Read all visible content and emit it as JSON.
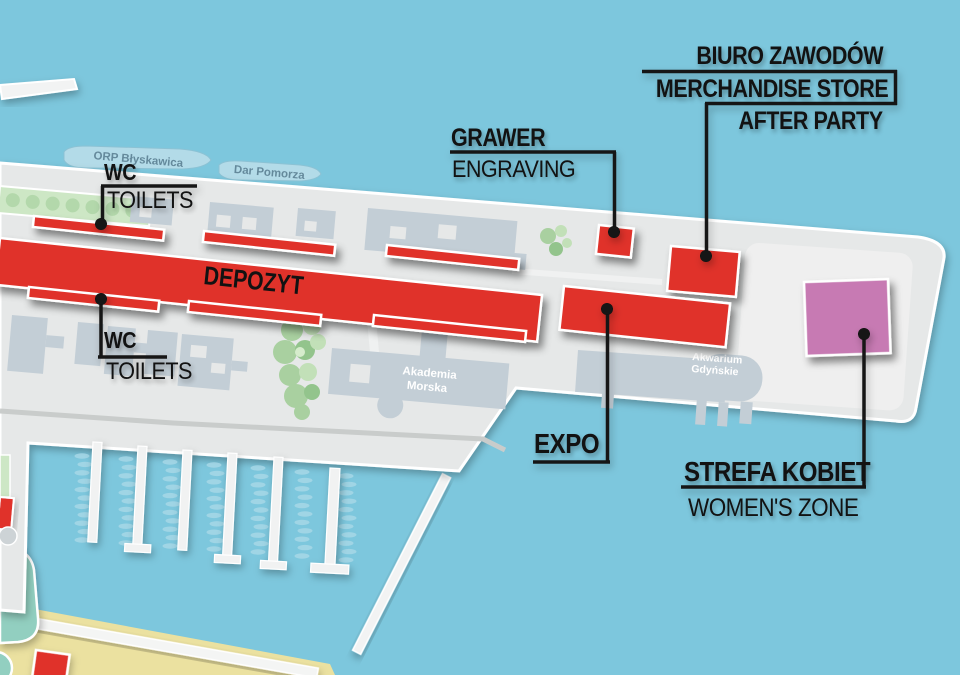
{
  "labels": {
    "wc_top": {
      "title": "WC",
      "subtitle": "TOILETS"
    },
    "wc_bottom": {
      "title": "WC",
      "subtitle": "TOILETS"
    },
    "grawer": {
      "title": "GRAWER",
      "subtitle": "ENGRAVING"
    },
    "biuro": {
      "line1": "BIURO ZAWODÓW",
      "line2": "MERCHANDISE STORE",
      "line3": "AFTER PARTY"
    },
    "expo": {
      "title": "EXPO"
    },
    "strefa": {
      "title": "STREFA KOBIET",
      "subtitle": "WOMEN'S ZONE"
    },
    "depozyt": {
      "title": "DEPOZYT"
    }
  },
  "places": {
    "ship_orp": "ORP Błyskawica",
    "ship_dar": "Dar Pomorza",
    "akademia_line1": "Akademia",
    "akademia_line2": "Morska",
    "akwarium_line1": "Akwarium",
    "akwarium_line2": "Gdyńskie"
  },
  "colors": {
    "water": "#7dc7dd",
    "land": "#e6e8e8",
    "land_light": "#efefef",
    "building": "#c3ced6",
    "red": "#e0322a",
    "pink": "#c77ab3",
    "tree": "#a9d0a0",
    "tree_light": "#cde7c5",
    "teal": "#92cfc0",
    "sand": "#ebe1a0",
    "boat": "#a9d8e7",
    "road": "#c9cccb",
    "ship": "#b3dbe8",
    "label_text": "#121212",
    "place_text": "#ffffff",
    "ship_text": "#64899b"
  }
}
